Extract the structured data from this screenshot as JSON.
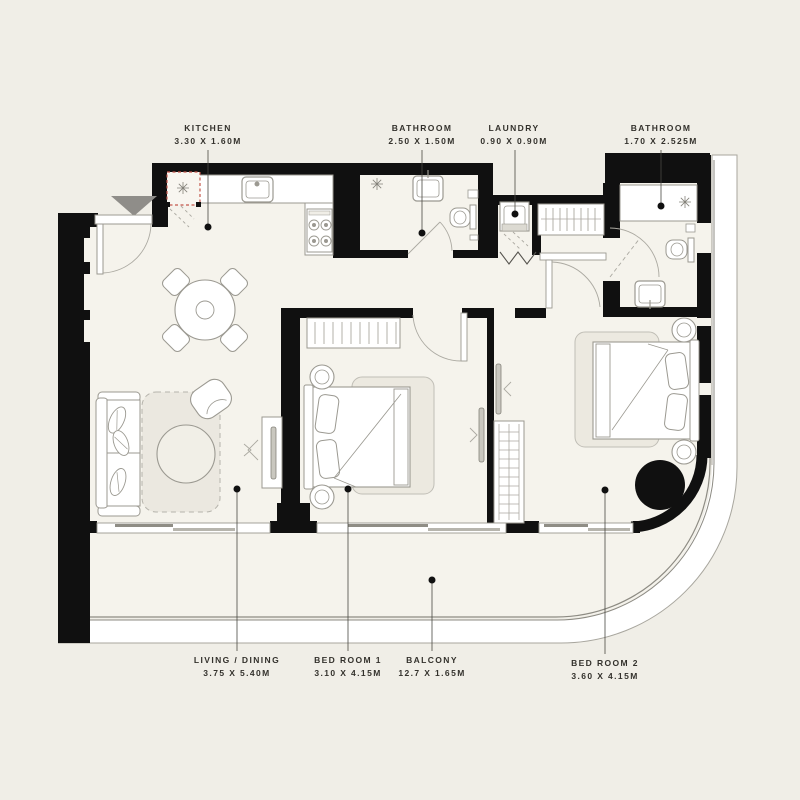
{
  "plan": {
    "rooms": [
      {
        "id": "kitchen",
        "label": "KITCHEN",
        "dims": "3.30 X 1.60M"
      },
      {
        "id": "bathroom-1",
        "label": "BATHROOM",
        "dims": "2.50 X 1.50M"
      },
      {
        "id": "laundry",
        "label": "LAUNDRY",
        "dims": "0.90 X 0.90M"
      },
      {
        "id": "bathroom-2",
        "label": "BATHROOM",
        "dims": "1.70 X 2.525M"
      },
      {
        "id": "living-dining",
        "label": "LIVING / DINING",
        "dims": "3.75 X 5.40M"
      },
      {
        "id": "bedroom-1",
        "label": "BED ROOM 1",
        "dims": "3.10 X 4.15M"
      },
      {
        "id": "balcony",
        "label": "BALCONY",
        "dims": "12.7 X 1.65M"
      },
      {
        "id": "bedroom-2",
        "label": "BED ROOM 2",
        "dims": "3.60 X 4.15M"
      }
    ],
    "colors": {
      "background": "#F0EEE7",
      "floor": "#F5F3EC",
      "wall": "#101010",
      "fixture_line": "#9B9991",
      "fridge_dashed_red": "#C4574B",
      "entry_marker_gray": "#8F8D89"
    },
    "icons": {
      "entry_marker": "triangle-down",
      "appliance_star": "asterisk",
      "leader_dot": "filled-circle",
      "structural_column": "filled-circle"
    }
  }
}
